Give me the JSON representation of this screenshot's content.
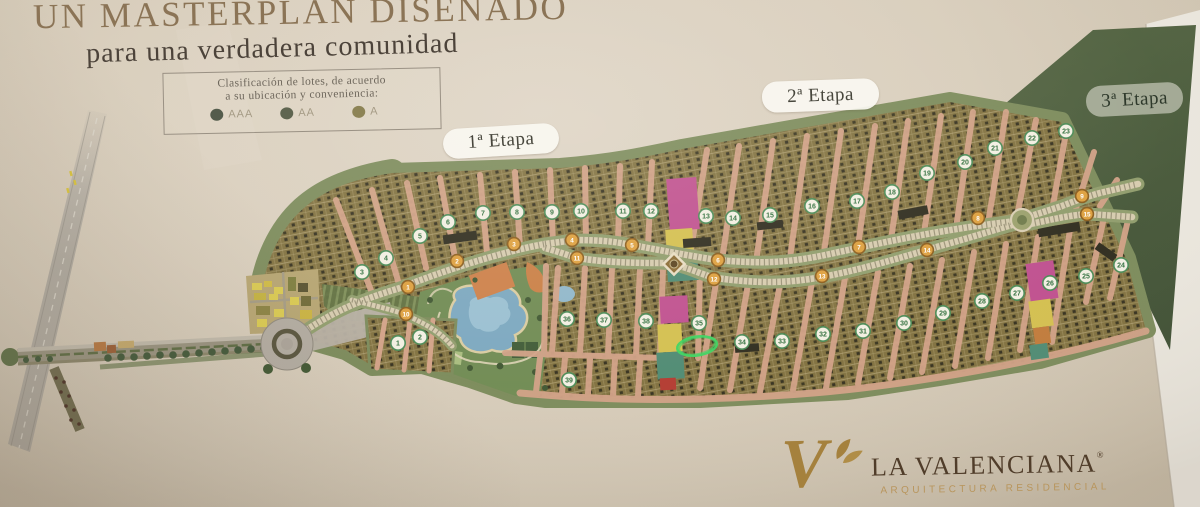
{
  "title": "UN MASTERPLAN DISEÑADO",
  "subtitle": "para una verdadera comunidad",
  "legend": {
    "line1": "Clasificación de lotes, de acuerdo",
    "line2": "a su ubicación y conveniencia:",
    "items": [
      {
        "label": "AAA",
        "color": "#545c4c"
      },
      {
        "label": "AA",
        "color": "#5f6550"
      },
      {
        "label": "A",
        "color": "#8d8456"
      }
    ]
  },
  "stages": [
    {
      "label": "1ª Etapa"
    },
    {
      "label": "2ª Etapa"
    },
    {
      "label": "3ª Etapa"
    }
  ],
  "map": {
    "block_markers": [
      {
        "n": "1",
        "x": 398,
        "y": 343
      },
      {
        "n": "2",
        "x": 420,
        "y": 337
      },
      {
        "n": "3",
        "x": 362,
        "y": 272
      },
      {
        "n": "4",
        "x": 386,
        "y": 258
      },
      {
        "n": "5",
        "x": 420,
        "y": 236
      },
      {
        "n": "6",
        "x": 448,
        "y": 222
      },
      {
        "n": "7",
        "x": 483,
        "y": 213
      },
      {
        "n": "8",
        "x": 517,
        "y": 212
      },
      {
        "n": "9",
        "x": 552,
        "y": 212
      },
      {
        "n": "10",
        "x": 581,
        "y": 211
      },
      {
        "n": "11",
        "x": 623,
        "y": 211
      },
      {
        "n": "12",
        "x": 651,
        "y": 211
      },
      {
        "n": "13",
        "x": 706,
        "y": 216
      },
      {
        "n": "14",
        "x": 733,
        "y": 218
      },
      {
        "n": "15",
        "x": 770,
        "y": 215
      },
      {
        "n": "16",
        "x": 812,
        "y": 206
      },
      {
        "n": "17",
        "x": 857,
        "y": 201
      },
      {
        "n": "18",
        "x": 892,
        "y": 192
      },
      {
        "n": "19",
        "x": 927,
        "y": 173
      },
      {
        "n": "20",
        "x": 965,
        "y": 162
      },
      {
        "n": "21",
        "x": 995,
        "y": 148
      },
      {
        "n": "22",
        "x": 1032,
        "y": 138
      },
      {
        "n": "23",
        "x": 1066,
        "y": 131
      },
      {
        "n": "24",
        "x": 1121,
        "y": 265
      },
      {
        "n": "25",
        "x": 1086,
        "y": 276
      },
      {
        "n": "26",
        "x": 1050,
        "y": 283
      },
      {
        "n": "27",
        "x": 1017,
        "y": 293
      },
      {
        "n": "28",
        "x": 982,
        "y": 301
      },
      {
        "n": "29",
        "x": 943,
        "y": 313
      },
      {
        "n": "30",
        "x": 904,
        "y": 323
      },
      {
        "n": "31",
        "x": 863,
        "y": 331
      },
      {
        "n": "32",
        "x": 823,
        "y": 334
      },
      {
        "n": "33",
        "x": 782,
        "y": 341
      },
      {
        "n": "34",
        "x": 742,
        "y": 342
      },
      {
        "n": "35",
        "x": 699,
        "y": 323
      },
      {
        "n": "36",
        "x": 567,
        "y": 319
      },
      {
        "n": "37",
        "x": 604,
        "y": 320
      },
      {
        "n": "38",
        "x": 646,
        "y": 321
      },
      {
        "n": "39",
        "x": 569,
        "y": 380
      }
    ],
    "road_markers": [
      {
        "n": "1",
        "x": 408,
        "y": 287
      },
      {
        "n": "2",
        "x": 457,
        "y": 261
      },
      {
        "n": "3",
        "x": 514,
        "y": 244
      },
      {
        "n": "4",
        "x": 572,
        "y": 240
      },
      {
        "n": "5",
        "x": 632,
        "y": 245
      },
      {
        "n": "6",
        "x": 718,
        "y": 260
      },
      {
        "n": "7",
        "x": 859,
        "y": 247
      },
      {
        "n": "8",
        "x": 978,
        "y": 218
      },
      {
        "n": "9",
        "x": 1082,
        "y": 196
      },
      {
        "n": "10",
        "x": 406,
        "y": 314
      },
      {
        "n": "11",
        "x": 577,
        "y": 258
      },
      {
        "n": "12",
        "x": 714,
        "y": 279
      },
      {
        "n": "13",
        "x": 822,
        "y": 276
      },
      {
        "n": "14",
        "x": 927,
        "y": 250
      },
      {
        "n": "15",
        "x": 1087,
        "y": 214
      }
    ],
    "highlight": {
      "x": 697,
      "y": 346,
      "rx": 20,
      "ry": 9.5,
      "rotation": -8,
      "color": "#3bd45f"
    }
  },
  "palette": {
    "paper": "#d5cab8",
    "block_olive": "#80703e",
    "road_salmon": "#d2a186",
    "green_band": "#7b8a5a",
    "stage3_green": "#485c3a",
    "lagoon_blue": "#7ba7bf",
    "gold_marker": "#dd9f3d",
    "block_marker_green": "#4a8a55",
    "magenta_lot": "#bf4f8e",
    "yellow_lot": "#d3bf4e",
    "highlight_green": "#3bd45f"
  },
  "logo": {
    "monogram": "V",
    "name": "LA VALENCIANA",
    "registered": "®",
    "tagline": "ARQUITECTURA RESIDENCIAL"
  }
}
